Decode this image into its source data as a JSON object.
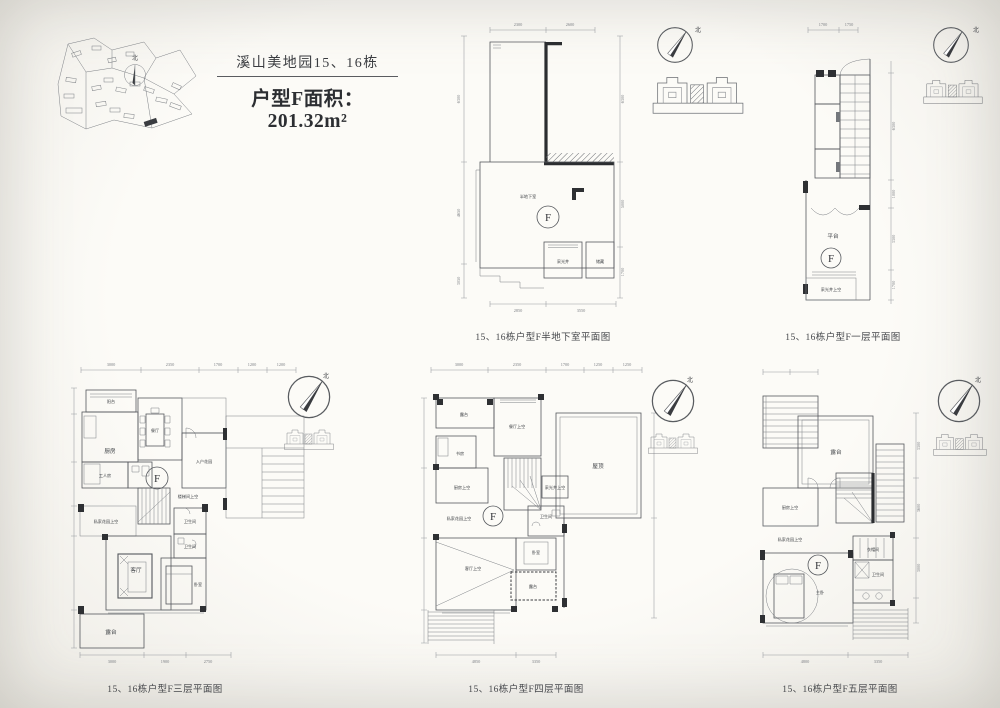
{
  "page": {
    "background": "#fbfaf6",
    "line_color": "#55585d",
    "wall_color": "#2b2d30"
  },
  "compass": {
    "north_label": "北"
  },
  "unit_marker": {
    "letter": "F"
  },
  "header": {
    "project_title": "溪山美地园15、16栋",
    "unit_title": "户型F面积：201.32m²"
  },
  "plans": {
    "basement": {
      "caption": "15、16栋户型F半地下室平面图",
      "labels": {
        "main_room": "半地下室",
        "light_well": "采光井",
        "storage": "储藏"
      },
      "dims": {
        "top": [
          "2300",
          "2600"
        ],
        "left": [
          "6300",
          "4650",
          "3050"
        ],
        "right": [
          "6300",
          "5000",
          "1700"
        ],
        "bottom": [
          "2850",
          "3550"
        ]
      }
    },
    "floor1": {
      "caption": "15、16栋户型F一层平面图",
      "labels": {
        "terrace": "平台",
        "light_well_void": "采光井上空"
      },
      "dims": {
        "top": [
          "1700",
          "1750"
        ],
        "right": [
          "6300",
          "1000",
          "3300",
          "1700"
        ]
      }
    },
    "floor3": {
      "caption": "15、16栋户型F三层平面图",
      "labels": {
        "balcony": "阳台",
        "kitchen": "厨房",
        "dining": "餐厅",
        "maid_room": "工人房",
        "entry_garden": "入户花园",
        "stair_void": "楼梯间上空",
        "garden_void": "私家花园上空",
        "living": "客厅",
        "bath1": "卫生间",
        "bath2": "卫生间",
        "bedroom": "卧室",
        "terrace": "露台"
      },
      "dims": {
        "top": [
          "3000",
          "2350",
          "1700",
          "1200",
          "1200"
        ],
        "bottom": [
          "3000",
          "1900",
          "2750"
        ]
      }
    },
    "floor4": {
      "caption": "15、16栋户型F四层平面图",
      "labels": {
        "terrace_top": "露台",
        "dining_void": "餐厅上空",
        "study": "书房",
        "kitchen_void": "厨房上空",
        "garden_void": "私家花园上空",
        "roof": "屋顶",
        "light_well_void": "采光井上空",
        "bath": "卫生间",
        "living_void": "客厅上空",
        "bedroom": "卧室",
        "terrace_bottom": "露台"
      },
      "dims": {
        "top": [
          "3000",
          "2350",
          "1700",
          "1250",
          "1250"
        ],
        "bottom": [
          "4850",
          "3350"
        ]
      }
    },
    "floor5": {
      "caption": "15、16栋户型F五层平面图",
      "labels": {
        "terrace": "露台",
        "kitchen_void": "厨房上空",
        "garden_void": "私家花园上空",
        "master_bedroom": "主卧",
        "closet": "衣帽间",
        "bath": "卫生间"
      },
      "dims": {
        "right": [
          "3300",
          "3600",
          "3000"
        ],
        "bottom": [
          "4800",
          "3350"
        ]
      }
    }
  }
}
